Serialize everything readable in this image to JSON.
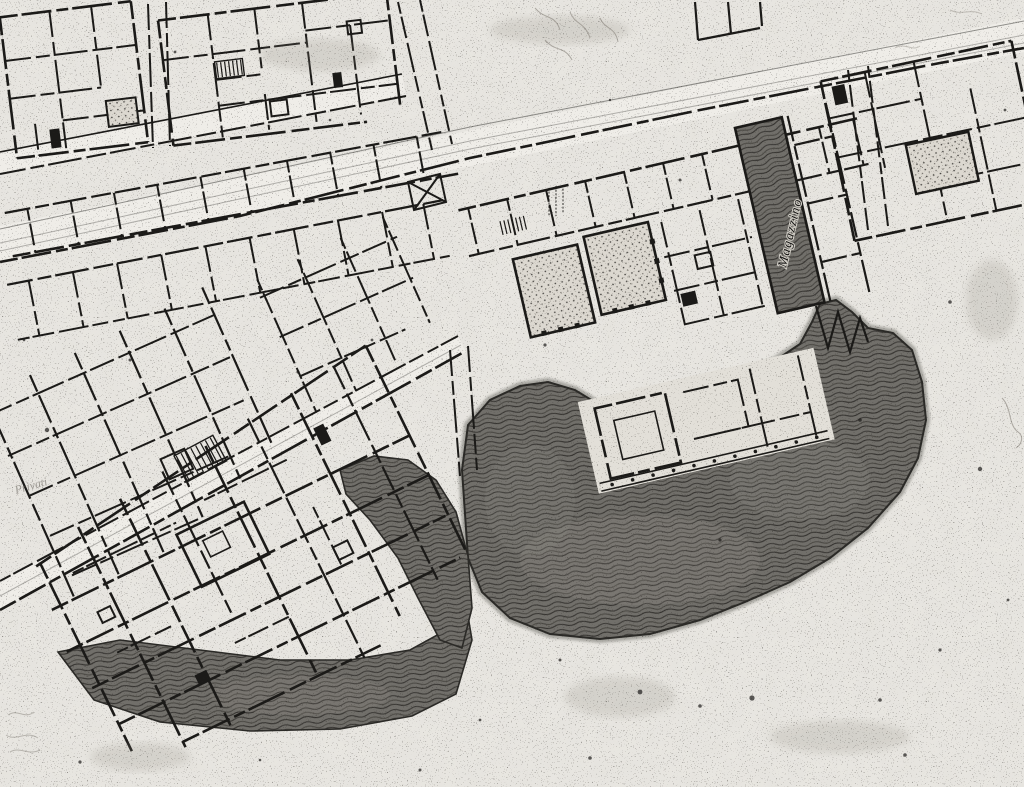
{
  "map": {
    "labels": {
      "magazzino": "Magazzino",
      "handwritten_note": "Privati"
    },
    "colors": {
      "paper": "#e9e7e2",
      "street": "#efede8",
      "ink": "#1b1a18",
      "mound_base": "#716f6a",
      "mound_hatch": "#3a3835",
      "mound_edge": "#33312e",
      "stipple_bg": "#dcd8d0",
      "inner_court": "#e2dfd8",
      "faint_line": "#8e8a82"
    },
    "features": [
      {
        "name": "main-street",
        "kind": "street"
      },
      {
        "name": "upper-parallel-street",
        "kind": "street"
      },
      {
        "name": "secondary-street",
        "kind": "street"
      },
      {
        "name": "top-left-insula-a",
        "kind": "building-block"
      },
      {
        "name": "top-left-insula-b",
        "kind": "building-block"
      },
      {
        "name": "street-frontage-row",
        "kind": "building-block"
      },
      {
        "name": "west-wedge-insula",
        "kind": "building-block"
      },
      {
        "name": "southwest-insula",
        "kind": "building-block"
      },
      {
        "name": "central-complex",
        "kind": "building-block"
      },
      {
        "name": "stippled-courts",
        "kind": "peristyle-courts"
      },
      {
        "name": "magazzino-strip",
        "kind": "hatched-building"
      },
      {
        "name": "northeast-block",
        "kind": "building-block"
      },
      {
        "name": "inner-courtyard-zone",
        "kind": "excavated-court"
      },
      {
        "name": "excavation-mound",
        "kind": "unexcavated-bank"
      },
      {
        "name": "southwest-mound-fringe",
        "kind": "unexcavated-bank"
      }
    ]
  }
}
